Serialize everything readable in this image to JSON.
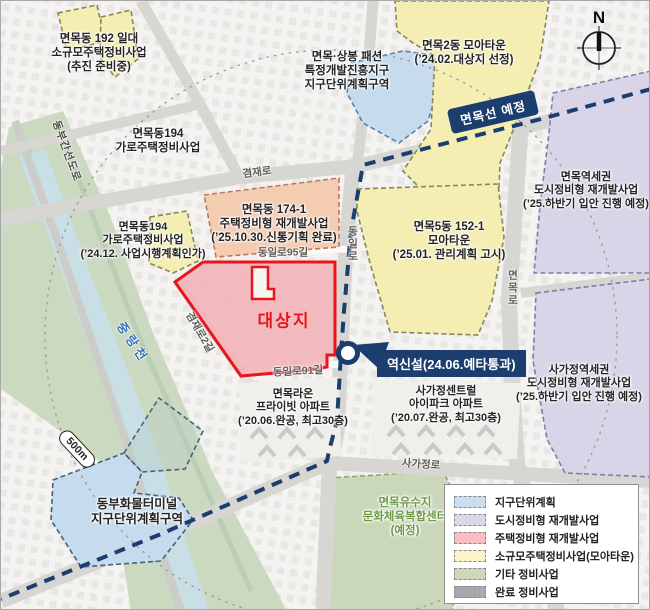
{
  "frame": {
    "compass": "N"
  },
  "badges": {
    "rail_line": "면목선 예정",
    "station": "역신설(24.06.예타통과)",
    "distance": "500m"
  },
  "target": {
    "label": "대상지"
  },
  "roads": {
    "gyeomjaero": "겸재로",
    "gyeomjaero2gil": "겸재로2길",
    "dongilro95gil": "동일로95길",
    "dongilro91gil": "동일로91길",
    "dongilro": "동일로",
    "myeonmokro": "면목로",
    "sagajeongro": "사가정로",
    "dongbu_expwy": "동부간선도로",
    "jungnangcheon": "중랑천"
  },
  "labels": {
    "l192": {
      "lines": [
        "면목동 192 일대",
        "소규모주택정비사업",
        "(추진 준비중)"
      ]
    },
    "l194a": {
      "lines": [
        "면목동194",
        "가로주택정비사업"
      ]
    },
    "fashion": {
      "lines": [
        "면목·상봉 패션",
        "특정개발진흥지구",
        "지구단위계획구역"
      ]
    },
    "moa2": {
      "lines": [
        "면목2동 모아타운",
        "(’24.02.대상지 선정)"
      ]
    },
    "yeokse": {
      "lines": [
        "면목역세권",
        "도시정비형 재개발사업",
        "(’25.하반기 입안 진행 예정)"
      ]
    },
    "l174": {
      "lines": [
        "면목동 174-1",
        "주택정비형 재개발사업",
        "(’25.10.30.신통기획 완료)"
      ]
    },
    "l194b": {
      "lines": [
        "면목동194",
        "가로주택정비사업",
        "(’24.12. 사업시행계획인가)"
      ]
    },
    "moa5": {
      "lines": [
        "면목5동 152-1",
        "모아타운",
        "(’25.01. 관리계획 고시)"
      ]
    },
    "sagase": {
      "lines": [
        "사가정역세권",
        "도시정비형 재개발사업",
        "(’25.하반기 입안 진행 예정)"
      ]
    },
    "raon": {
      "lines": [
        "면목라온",
        "프라이빗 아파트",
        "(’20.06.완공, 최고30층)"
      ]
    },
    "central": {
      "lines": [
        "사가정센트럴",
        "아이파크 아파트",
        "(’20.07.완공, 최고30층)"
      ]
    },
    "terminal": {
      "lines": [
        "동부화물터미널",
        "지구단위계획구역"
      ]
    },
    "yususji": {
      "lines": [
        "면목유수지",
        "문화체육복합센터",
        "(예정)"
      ]
    }
  },
  "legend": {
    "items": [
      {
        "label": "지구단위계획",
        "color": "#c9def0"
      },
      {
        "label": "도시정비형 재개발사업",
        "color": "#dcd6e9"
      },
      {
        "label": "주택정비형 재개발사업",
        "color": "#f9bdc2"
      },
      {
        "label": "소규모주택정비사업(모아타운)",
        "color": "#faf4c8"
      },
      {
        "label": "기타 정비사업",
        "color": "#ccd8b8"
      },
      {
        "label": "완료 정비사업",
        "color": "#a7a9ac"
      }
    ]
  },
  "colors": {
    "rail": "#1c3e6e",
    "target_border": "#e8151c",
    "target_fill": "#f3aeb3"
  }
}
